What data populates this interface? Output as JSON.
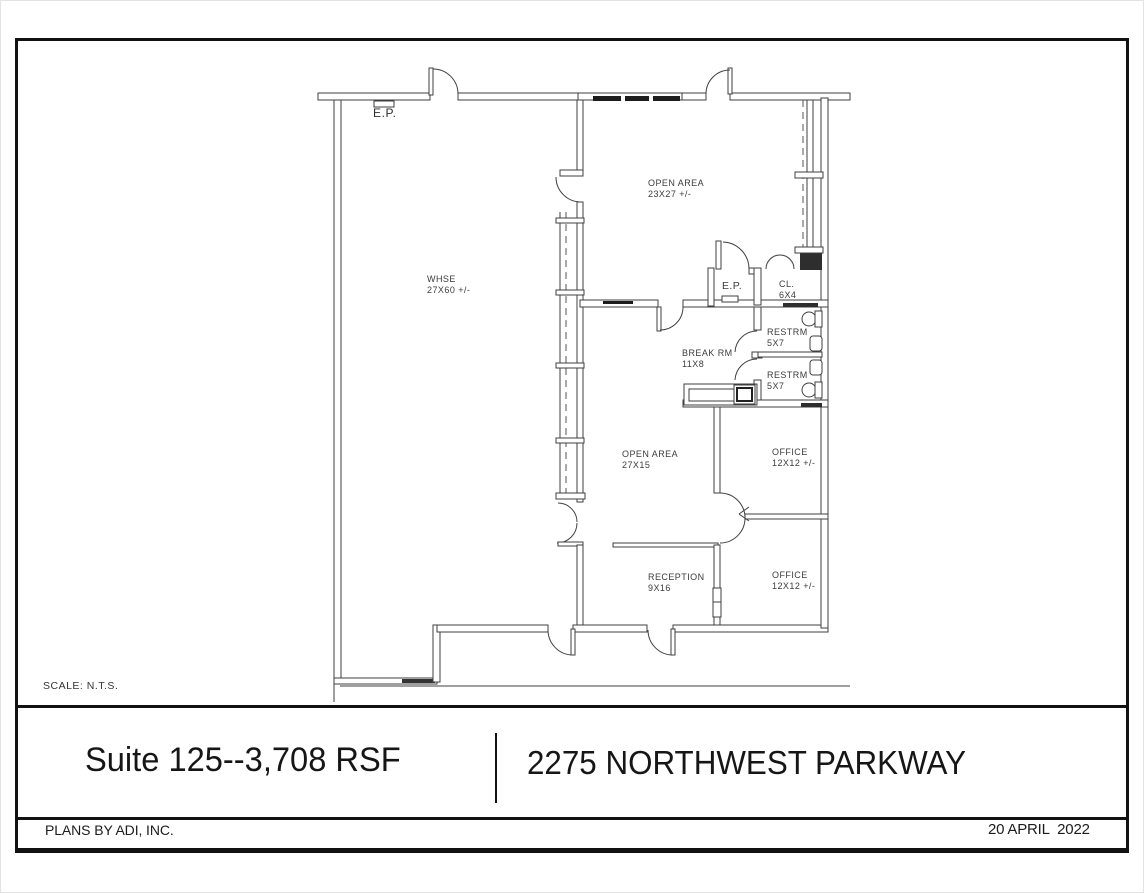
{
  "sheet": {
    "scale_note": "SCALE:  N.T.S.",
    "title_block": {
      "suite_label": "Suite 125--3,708 RSF",
      "address": "2275 NORTHWEST PARKWAY"
    },
    "footer": {
      "company": "PLANS BY ADI, INC.",
      "date": "20 APRIL  2022"
    }
  },
  "plan": {
    "labels": [
      {
        "key": "ep-top",
        "line1": "E.P.",
        "line2": ""
      },
      {
        "key": "open-area-north",
        "line1": "OPEN AREA",
        "line2": "23X27 +/-"
      },
      {
        "key": "whse",
        "line1": "WHSE",
        "line2": "27X60 +/-"
      },
      {
        "key": "ep-closet",
        "line1": "E.P.",
        "line2": ""
      },
      {
        "key": "closet",
        "line1": "CL.",
        "line2": "6X4"
      },
      {
        "key": "restroom-1",
        "line1": "RESTRM",
        "line2": "5X7"
      },
      {
        "key": "restroom-2",
        "line1": "RESTRM",
        "line2": "5X7"
      },
      {
        "key": "break-room",
        "line1": "BREAK RM",
        "line2": "11X8"
      },
      {
        "key": "open-area-south",
        "line1": "OPEN AREA",
        "line2": "27X15"
      },
      {
        "key": "office-1",
        "line1": "OFFICE",
        "line2": "12X12 +/-"
      },
      {
        "key": "office-2",
        "line1": "OFFICE",
        "line2": "12X12 +/-"
      },
      {
        "key": "reception",
        "line1": "RECEPTION",
        "line2": "9X16"
      }
    ]
  }
}
